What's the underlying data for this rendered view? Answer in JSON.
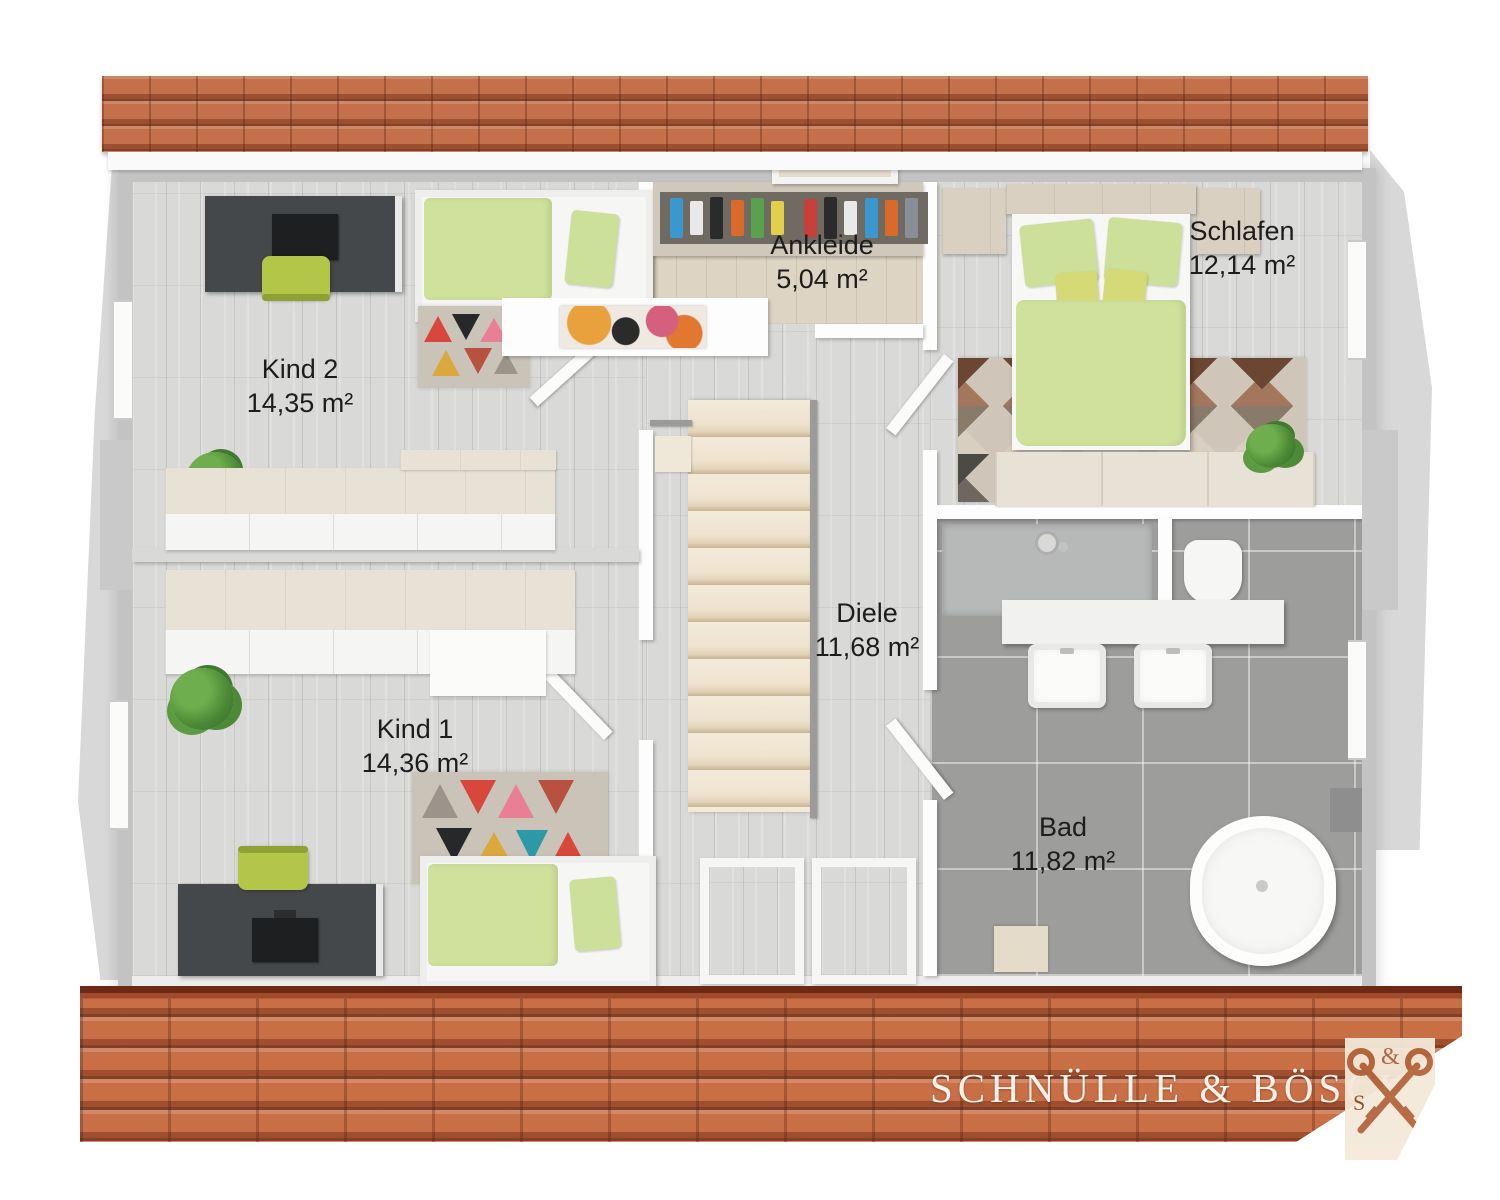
{
  "floorplan": {
    "title": "Obergeschoss Grundriss",
    "rooms": [
      {
        "id": "kind2",
        "name": "Kind 2",
        "area": "14,35 m²"
      },
      {
        "id": "ankleide",
        "name": "Ankleide",
        "area": "5,04 m²"
      },
      {
        "id": "schlafen",
        "name": "Schlafen",
        "area": "12,14 m²"
      },
      {
        "id": "diele",
        "name": "Diele",
        "area": "11,68 m²"
      },
      {
        "id": "kind1",
        "name": "Kind 1",
        "area": "14,36 m²"
      },
      {
        "id": "bad",
        "name": "Bad",
        "area": "11,82 m²"
      }
    ]
  },
  "branding": {
    "company": "SCHNÜLLE & BÖSCH",
    "logo": {
      "letter_s": "S",
      "ampersand": "&"
    }
  },
  "colors": {
    "roof_tile": "#c4714b",
    "roof_ridge": "#6e2816",
    "wood_floor": "#d9d9d7",
    "beige_floor": "#ddd4c4",
    "bath_tile": "#9d9d9c",
    "accent_green": "#cfe19b",
    "logo_bg": "#f4e9da",
    "logo_fg": "#b4653c"
  }
}
